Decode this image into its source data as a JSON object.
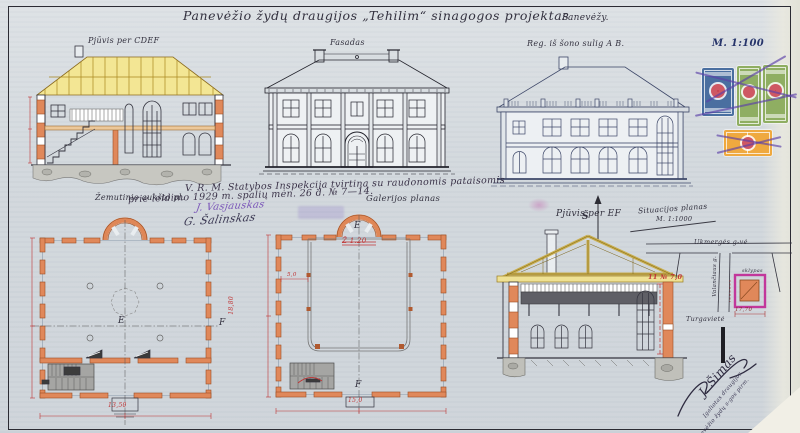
{
  "sheet": {
    "title": "Panevėžio žydų draugijos „Tehilim“ sinagogos projektas",
    "place": "Panevėžy.",
    "scale_main": "M. 1:100"
  },
  "labels": {
    "section_cdef": "Pjūvis per CDEF",
    "facade": "Fasadas",
    "side_view": "Reg. iš šono sulig A B.",
    "ground_plan": "Žemutinio aukšto pl.",
    "gallery_plan": "Galerijos planas",
    "section_ef": "Pjūvis per EF",
    "site_plan": "Situacijos planas",
    "site_scale": "M. 1:1000",
    "north": "Š"
  },
  "approval": {
    "line1": "V. R. M. Statybos Inspekcija tvirtina su raudonomis pataisomis",
    "line2": "prie leidimo 1929 m. spalių mėn. 26 d. № 7—14.",
    "signature1": "J. Vasjauskas",
    "signature2": "G. Šalinskas"
  },
  "marks": {
    "e": "E",
    "f": "F"
  },
  "corrections": {
    "gallery_note": "Ž 1.20",
    "section_note": "11 № 7,0",
    "dim_gallery_width": "15,0",
    "dim_ground_width": "13,50",
    "dim_gallery_height": "18,80",
    "dim_inner": "5,0"
  },
  "site": {
    "street_top": "Ukmergės g-vė",
    "street_left": "Valančiaus g.",
    "plot_label": "sklypas",
    "bottom_label": "Turgavietė",
    "plot_width": "17,70"
  },
  "signature_block": {
    "name": "J. Šimas",
    "line1": "Įgaliotas draugijos",
    "line2": "Panevėžio žydų s-gos pirm."
  }
}
